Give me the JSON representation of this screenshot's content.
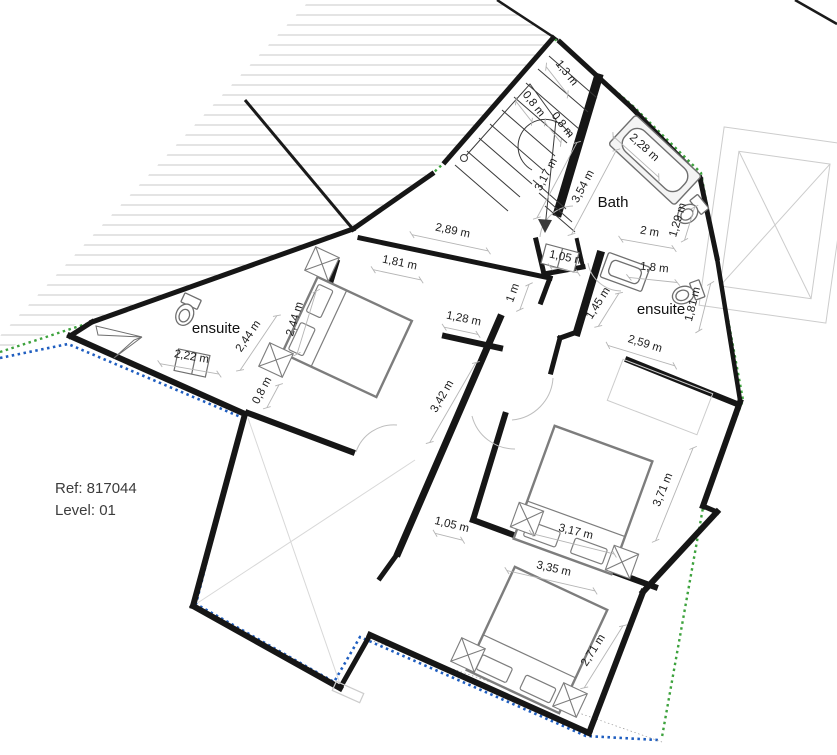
{
  "annotation": {
    "ref": "Ref: 817044",
    "level": "Level: 01"
  },
  "rooms": [
    {
      "label": "Bath",
      "x": 613,
      "y": 207,
      "size": 15
    },
    {
      "label": "ensuite",
      "x": 661,
      "y": 314,
      "size": 15
    },
    {
      "label": "ensuite",
      "x": 216,
      "y": 333,
      "size": 15
    }
  ],
  "dimensions": [
    {
      "label": "1,3 m",
      "x": 564,
      "y": 75,
      "rot": 52
    },
    {
      "label": "0,8 m",
      "x": 531,
      "y": 106,
      "rot": 52
    },
    {
      "label": "0,8 m",
      "x": 560,
      "y": 127,
      "rot": 52
    },
    {
      "label": "3,17 m",
      "x": 549,
      "y": 176,
      "rot": -62
    },
    {
      "label": "3,54 m",
      "x": 586,
      "y": 188,
      "rot": -62
    },
    {
      "label": "2,28 m",
      "x": 642,
      "y": 150,
      "rot": 42
    },
    {
      "label": "1,29 m",
      "x": 681,
      "y": 221,
      "rot": -73
    },
    {
      "label": "2 m",
      "x": 649,
      "y": 235,
      "rot": 10
    },
    {
      "label": "1,05 m",
      "x": 566,
      "y": 261,
      "rot": 12
    },
    {
      "label": "1,8 m",
      "x": 654,
      "y": 271,
      "rot": 6
    },
    {
      "label": "1,81 m",
      "x": 696,
      "y": 305,
      "rot": -76
    },
    {
      "label": "1,45 m",
      "x": 601,
      "y": 305,
      "rot": -58
    },
    {
      "label": "2,59 m",
      "x": 644,
      "y": 347,
      "rot": 17
    },
    {
      "label": "2,89 m",
      "x": 452,
      "y": 234,
      "rot": 12
    },
    {
      "label": "1,81 m",
      "x": 399,
      "y": 266,
      "rot": 12
    },
    {
      "label": "2,44 m",
      "x": 251,
      "y": 338,
      "rot": -56
    },
    {
      "label": "2,44 m",
      "x": 298,
      "y": 320,
      "rot": -73
    },
    {
      "label": "2,22 m",
      "x": 191,
      "y": 360,
      "rot": 10
    },
    {
      "label": "0,8 m",
      "x": 265,
      "y": 392,
      "rot": -62
    },
    {
      "label": "1,28 m",
      "x": 463,
      "y": 322,
      "rot": 12
    },
    {
      "label": "1 m",
      "x": 516,
      "y": 294,
      "rot": -70
    },
    {
      "label": "3,42 m",
      "x": 445,
      "y": 398,
      "rot": -60
    },
    {
      "label": "1,05 m",
      "x": 451,
      "y": 528,
      "rot": 14
    },
    {
      "label": "3,17 m",
      "x": 575,
      "y": 535,
      "rot": 14
    },
    {
      "label": "3,35 m",
      "x": 553,
      "y": 572,
      "rot": 13
    },
    {
      "label": "3,71 m",
      "x": 666,
      "y": 491,
      "rot": -68
    },
    {
      "label": "2,71 m",
      "x": 596,
      "y": 652,
      "rot": -58
    }
  ],
  "colors": {
    "wall": "#161616",
    "hatch": "#c9c9c9",
    "dimension_line": "#b5b5b5",
    "dimension_text": "#1c1c1c",
    "room_text": "#111111",
    "furniture": "#7d7d7d",
    "furniture_light": "#cccccc",
    "fixture": "#6f6f6f",
    "boundary_green": "#3da23d",
    "boundary_blue": "#1f5ec0",
    "ref_text": "#3c3c3c"
  }
}
